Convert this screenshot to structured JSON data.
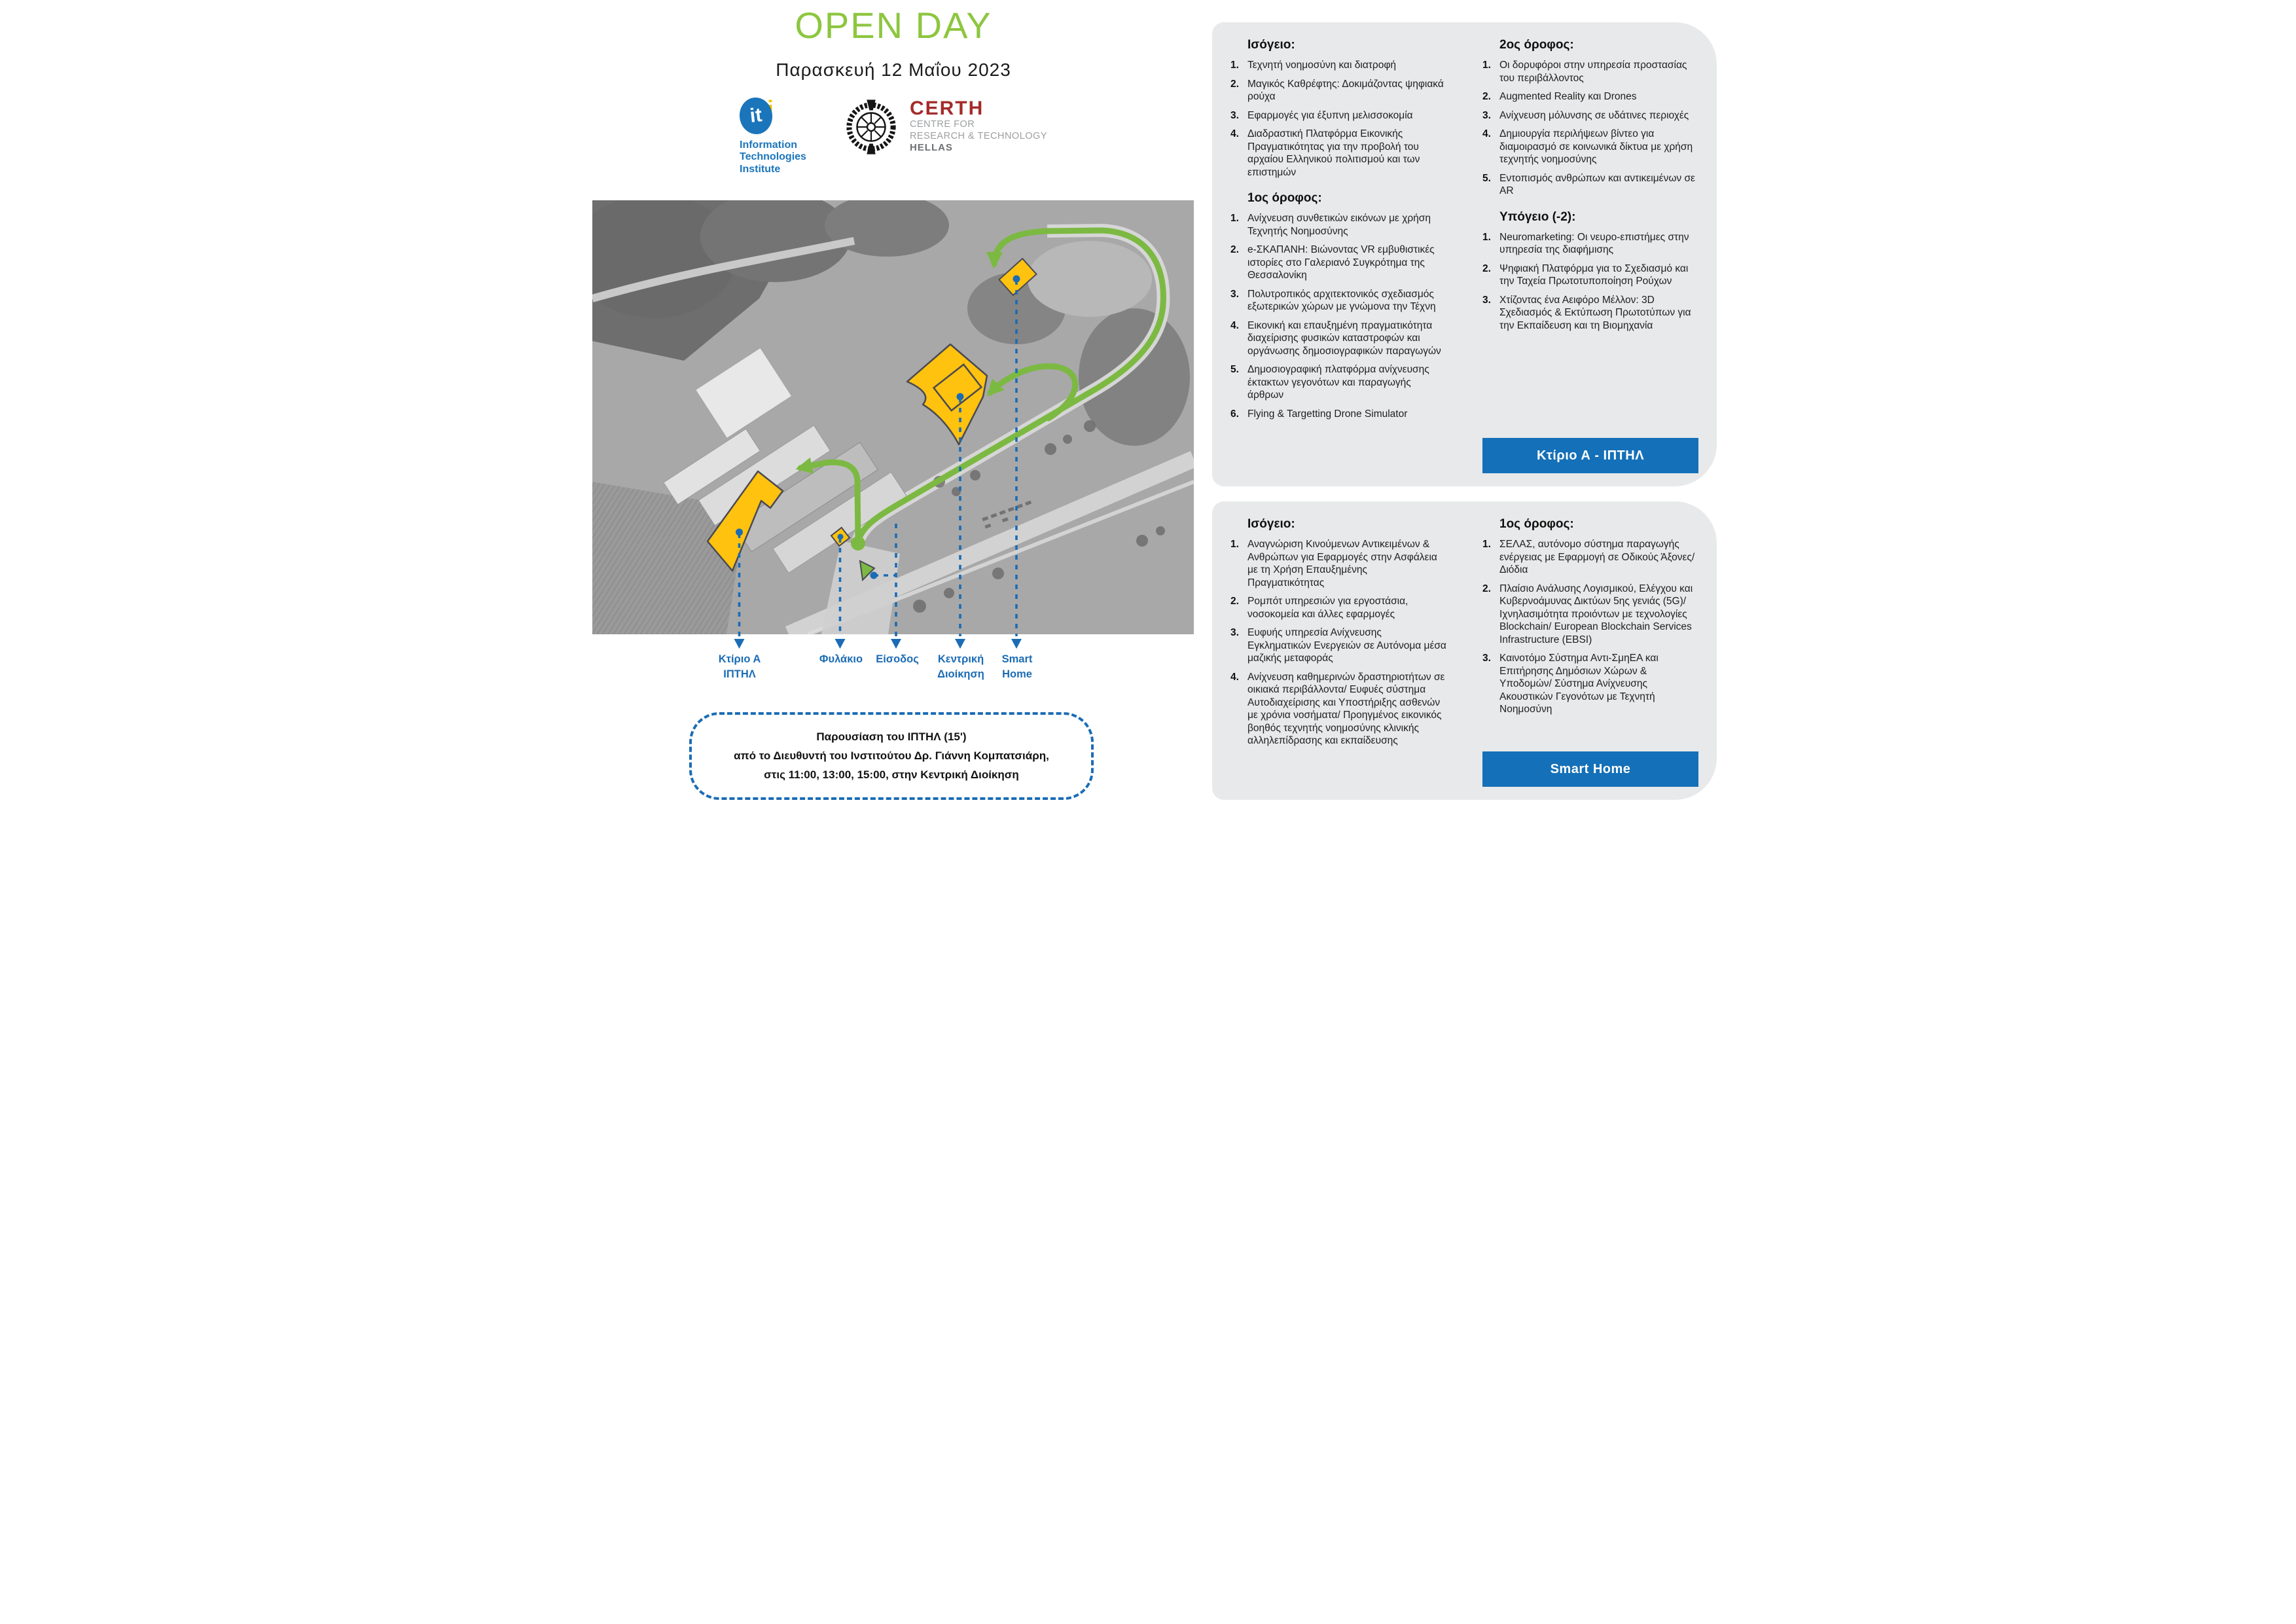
{
  "colors": {
    "title_green": "#8dc63f",
    "route_green": "#7cb942",
    "label_blue": "#1b6cb5",
    "button_blue": "#1470b8",
    "box_background": "#e8e9ea",
    "building_yellow": "#ffc20e",
    "certh_red": "#a42b2b"
  },
  "header": {
    "title": "OPEN DAY",
    "date": "Παρασκευή 12 Μαΐου 2023",
    "iti": {
      "mark_it": "it",
      "mark_i": "i",
      "lines": [
        "Information",
        "Technologies",
        "Institute"
      ]
    },
    "certh": {
      "acronym": "CERTH",
      "lines": [
        "CENTRE FOR",
        "RESEARCH & TECHNOLOGY"
      ],
      "hellas": "HELLAS"
    }
  },
  "map": {
    "labels": [
      {
        "lines": [
          "Κτίριο Α",
          "ΙΠΤΗΛ"
        ]
      },
      {
        "lines": [
          "Φυλάκιο"
        ]
      },
      {
        "lines": [
          "Είσοδος"
        ]
      },
      {
        "lines": [
          "Κεντρική",
          "Διοίκηση"
        ]
      },
      {
        "lines": [
          "Smart",
          "Home"
        ]
      }
    ]
  },
  "note": {
    "lines": [
      "Παρουσίαση του ΙΠΤΗΛ  (15')",
      "από το Διευθυντή του Ινστιτούτου Δρ. Γιάννη Κομπατσιάρη,",
      "στις 11:00, 13:00, 15:00, στην Κεντρική Διοίκηση"
    ]
  },
  "building_a_box": {
    "button_label": "Κτίριο Α - ΙΠΤΗΛ",
    "columns": [
      {
        "sections": [
          {
            "heading": "Ισόγειο:",
            "items": [
              {
                "n": "1.",
                "t": "Τεχνητή νοημοσύνη και διατροφή"
              },
              {
                "n": "2.",
                "t": "Μαγικός Καθρέφτης: Δοκιμάζοντας ψηφιακά ρούχα"
              },
              {
                "n": "3.",
                "t": "Εφαρμογές για έξυπνη μελισσοκομία"
              },
              {
                "n": "4.",
                "t": "Διαδραστική Πλατφόρμα Εικονικής Πραγματικότητας για την προβολή του αρχαίου Ελληνικού πολιτισμού και των επιστημών"
              }
            ]
          },
          {
            "heading": "1ος όροφος:",
            "items": [
              {
                "n": "1.",
                "t": "Ανίχνευση συνθετικών εικόνων με χρήση Τεχνητής Νοημοσύνης"
              },
              {
                "n": "2.",
                "t": "e-ΣΚΑΠΑΝΗ: Βιώνοντας VR εμβυθιστικές ιστορίες στο Γαλεριανό Συγκρότημα της Θεσσαλονίκη"
              },
              {
                "n": "3.",
                "t": "Πολυτροπικός αρχιτεκτονικός σχεδιασμός εξωτερικών χώρων με γνώμονα την Τέχνη"
              },
              {
                "n": "4.",
                "t": "Εικονική και επαυξημένη πραγματικότητα διαχείρισης φυσικών καταστροφών και οργάνωσης δημοσιογραφικών παραγωγών"
              },
              {
                "n": "5.",
                "t": "Δημοσιογραφική πλατφόρμα ανίχνευσης έκτακτων γεγονότων και παραγωγής άρθρων"
              },
              {
                "n": "6.",
                "t": "Flying & Targetting Drone Simulator"
              }
            ]
          }
        ]
      },
      {
        "sections": [
          {
            "heading": "2ος όροφος:",
            "items": [
              {
                "n": "1.",
                "t": "Οι δορυφόροι στην υπηρεσία προστασίας του περιβάλλοντος"
              },
              {
                "n": "2.",
                "t": "Augmented Reality και Drones"
              },
              {
                "n": "3.",
                "t": "Ανίχνευση μόλυνσης σε υδάτινες περιοχές"
              },
              {
                "n": "4.",
                "t": "Δημιουργία περιλήψεων βίντεο για διαμοιρασμό σε κοινωνικά δίκτυα με χρήση τεχνητής νοημοσύνης"
              },
              {
                "n": "5.",
                "t": "Εντοπισμός ανθρώπων και αντικειμένων σε AR"
              }
            ]
          },
          {
            "heading": "Υπόγειο (-2):",
            "items": [
              {
                "n": "1.",
                "t": "Neuromarketing: Οι νευρο-επιστήμες στην υπηρεσία της διαφήμισης"
              },
              {
                "n": "2.",
                "t": "Ψηφιακή Πλατφόρμα για το Σχεδιασμό και την Ταχεία Πρωτοτυποποίηση Ρούχων"
              },
              {
                "n": "3.",
                "t": "Χτίζοντας ένα Αειφόρο Μέλλον: 3D Σχεδιασμός & Εκτύπωση Πρωτοτύπων για την Εκπαίδευση και τη Βιομηχανία"
              }
            ]
          }
        ]
      }
    ]
  },
  "smart_home_box": {
    "button_label": "Smart Home",
    "columns": [
      {
        "sections": [
          {
            "heading": "Ισόγειο:",
            "items": [
              {
                "n": "1.",
                "t": "Αναγνώριση Κινούμενων Αντικειμένων & Ανθρώπων για Εφαρμογές στην Ασφάλεια με τη Χρήση Επαυξημένης Πραγματικότητας"
              },
              {
                "n": "2.",
                "t": "Ρομπότ υπηρεσιών για εργοστάσια, νοσοκομεία και άλλες εφαρμογές"
              },
              {
                "n": "3.",
                "t": "Ευφυής υπηρεσία Ανίχνευσης Εγκληματικών Ενεργειών σε Αυτόνομα μέσα μαζικής μεταφοράς"
              },
              {
                "n": "4.",
                "t": "Ανίχνευση καθημερινών δραστηριοτήτων σε οικιακά περιβάλλοντα/ Ευφυές σύστημα Αυτοδιαχείρισης και Υποστήριξης ασθενών με χρόνια νοσήματα/ Προηγμένος εικονικός βοηθός τεχνητής νοημοσύνης κλινικής αλληλεπίδρασης και εκπαίδευσης"
              }
            ]
          }
        ]
      },
      {
        "sections": [
          {
            "heading": "1ος όροφος:",
            "items": [
              {
                "n": "1.",
                "t": "ΣΕΛΑΣ, αυτόνομο σύστημα παραγωγής ενέργειας με Εφαρμογή σε Οδικούς Άξονες/ Διόδια"
              },
              {
                "n": "2.",
                "t": "Πλαίσιο Ανάλυσης Λογισμικού, Ελέγχου και Κυβερνοάμυνας Δικτύων 5ης γενιάς (5G)/ Ιχνηλασιμότητα προιόντων με τεχνολογίες Blockchain/ European Blockchain Services Infrastructure (EBSI)"
              },
              {
                "n": "3.",
                "t": "Καινοτόμο Σύστημα Αντι-ΣμηΕΑ και Επιτήρησης Δημόσιων Χώρων & Υποδομών/ Σύστημα Ανίχνευσης Ακουστικών Γεγονότων με Τεχνητή Νοημοσύνη"
              }
            ]
          }
        ]
      }
    ]
  }
}
